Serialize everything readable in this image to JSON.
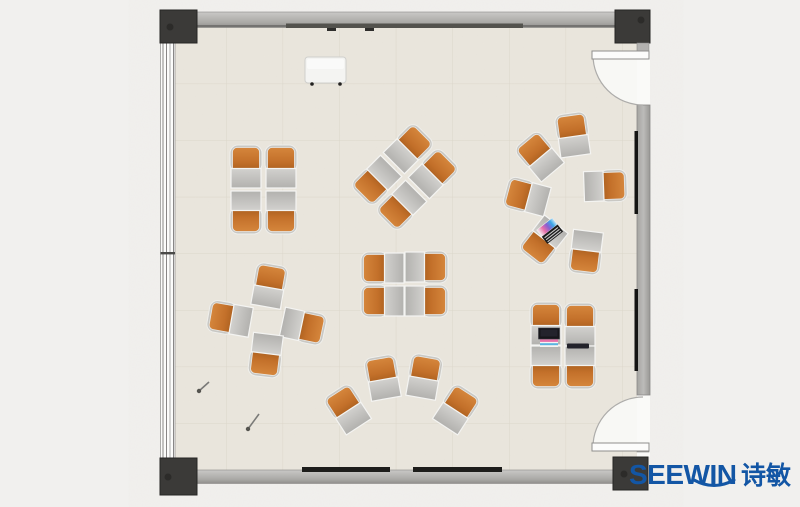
{
  "logo": {
    "brand": "SEEWIN",
    "brand_cn": "诗敏",
    "color": "#1356a5"
  },
  "palette": {
    "background": "#f1f0ee",
    "floor": "#eae6dd",
    "floor_grid": "#dcd7cb",
    "wall_light": "#c9c8c6",
    "wall_dark": "#93928f",
    "column": "#3b3a38",
    "chair_orange": "#cf8038",
    "chair_orange_dark": "#a65d1d",
    "desk_gray": "#c6c5c2",
    "board_black": "#1d1d1b",
    "door_arc": "#adacaa"
  },
  "furniture": {
    "clusters": [
      {
        "name": "pod-4-top-left",
        "units": [
          {
            "x": 246,
            "y": 168,
            "r": 0
          },
          {
            "x": 281,
            "y": 168,
            "r": 0
          },
          {
            "x": 246,
            "y": 211,
            "r": 180
          },
          {
            "x": 281,
            "y": 211,
            "r": 180
          }
        ]
      },
      {
        "name": "pod-4-diagonal",
        "units": [
          {
            "x": 408,
            "y": 149,
            "r": 45
          },
          {
            "x": 433,
            "y": 174,
            "r": 45
          },
          {
            "x": 377,
            "y": 180,
            "r": 225
          },
          {
            "x": 402,
            "y": 205,
            "r": 225
          }
        ]
      },
      {
        "name": "circle-6-right",
        "units": [
          {
            "x": 573,
            "y": 136,
            "r": -8
          },
          {
            "x": 540,
            "y": 157,
            "r": -40
          },
          {
            "x": 528,
            "y": 197,
            "r": -75
          },
          {
            "x": 544,
            "y": 240,
            "r": -142
          },
          {
            "x": 586,
            "y": 251,
            "r": 187
          },
          {
            "x": 604,
            "y": 186,
            "r": 88
          }
        ]
      },
      {
        "name": "pinwheel-4-left",
        "units": [
          {
            "x": 269,
            "y": 287,
            "r": 10
          },
          {
            "x": 231,
            "y": 319,
            "r": -80
          },
          {
            "x": 302,
            "y": 326,
            "r": 102
          },
          {
            "x": 266,
            "y": 354,
            "r": 187
          }
        ]
      },
      {
        "name": "pod-4-middle",
        "units": [
          {
            "x": 384,
            "y": 268,
            "r": -90
          },
          {
            "x": 425,
            "y": 267,
            "r": 90
          },
          {
            "x": 384,
            "y": 301,
            "r": -90
          },
          {
            "x": 425,
            "y": 301,
            "r": 90
          }
        ]
      },
      {
        "name": "arc-4-bottom",
        "units": [
          {
            "x": 348,
            "y": 410,
            "r": -33
          },
          {
            "x": 383,
            "y": 379,
            "r": -10
          },
          {
            "x": 424,
            "y": 378,
            "r": 10
          },
          {
            "x": 456,
            "y": 410,
            "r": 33
          }
        ]
      },
      {
        "name": "pod-4-bottom-right",
        "units": [
          {
            "x": 546,
            "y": 325,
            "r": 0
          },
          {
            "x": 580,
            "y": 326,
            "r": 0
          },
          {
            "x": 546,
            "y": 366,
            "r": 180
          },
          {
            "x": 580,
            "y": 366,
            "r": 180
          }
        ]
      }
    ],
    "props": [
      {
        "type": "laptop-open",
        "x": 550,
        "y": 231,
        "r": -38
      },
      {
        "type": "laptop-flat",
        "x": 549,
        "y": 336,
        "r": 0
      },
      {
        "type": "tablet",
        "x": 578,
        "y": 346,
        "r": 0
      }
    ],
    "pins": [
      {
        "x1": 199,
        "y1": 391,
        "x2": 209,
        "y2": 382
      },
      {
        "x1": 248,
        "y1": 429,
        "x2": 259,
        "y2": 414
      }
    ]
  }
}
